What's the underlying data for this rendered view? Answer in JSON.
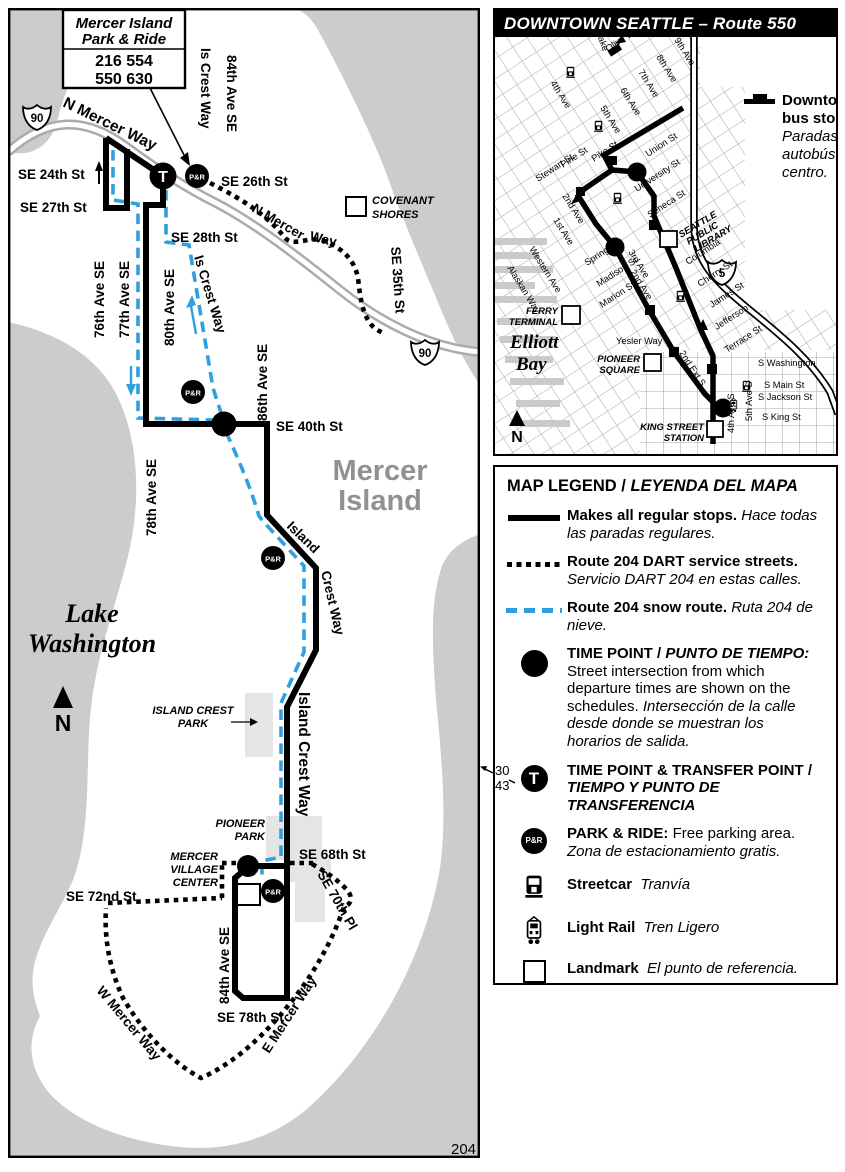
{
  "theme": {
    "snow_route_blue": "#2FA0DB",
    "water_gray": "#CBCDCC",
    "park_gray": "#E4E5E5",
    "route_black": "#000000"
  },
  "main_map": {
    "t": "T",
    "pr": "P&R",
    "shield": "90",
    "page": "204",
    "box": {
      "line1": "Mercer Island",
      "line2": "Park & Ride",
      "row1": "216  554",
      "row2": "550  630"
    },
    "streets": {
      "nmw": "N Mercer Way",
      "se24": "SE 24th St",
      "se27": "SE 27th St",
      "a76": "76th Ave SE",
      "a77": "77th Ave SE",
      "iscn": "Is Crest Way",
      "a84n": "84th Ave SE",
      "se26": "SE 26th St",
      "nm2a": "N Mercer",
      "nm2b": "Way",
      "se28": "SE 28th St",
      "se35": "SE 35th St",
      "a80": "80th Ave SE",
      "iscm": "Is Crest Way",
      "a86": "86th Ave SE",
      "se40": "SE 40th St",
      "a78": "78th Ave SE",
      "icw1a": "Island",
      "icw1b": "Crest Way",
      "icw2": "Island Crest Way",
      "se68": "SE 68th St",
      "se72": "SE 72nd St",
      "se70": "SE 70th Pl",
      "a84s": "84th Ave SE",
      "se78": "SE 78th St",
      "wm": "W Mercer Way",
      "em": "E Mercer Way"
    },
    "places": {
      "m1": "Mercer",
      "m2": "Island",
      "l1": "Lake",
      "l2": "Washington",
      "cov1": "COVENANT",
      "cov2": "SHORES",
      "icp1": "ISLAND CREST",
      "icp2": "PARK",
      "pp1": "PIONEER",
      "pp2": "PARK",
      "mv1": "MERCER",
      "mv2": "VILLAGE",
      "mv3": "CENTER",
      "north": "N"
    }
  },
  "inset": {
    "title": "DOWNTOWN SEATTLE – Route 550",
    "shield": "5",
    "stops_legend": {
      "l1": "Downtown",
      "l2": "bus stops.",
      "l3": "Paradas de",
      "l4": "autobús del",
      "l5": "centro."
    },
    "streets": {
      "a4": "4th Ave",
      "a5": "5th Ave",
      "a6": "6th Ave",
      "a7": "7th Ave",
      "a8": "8th Ave",
      "a9": "9th Ave",
      "olive": "Olive Way",
      "westlake": "Westlake",
      "stewart": "Stewart St",
      "pine": "Pine St",
      "pike": "Pike St",
      "union": "Union St",
      "university": "University St",
      "seneca": "Seneca St",
      "spring": "Spring St",
      "madison": "Madison St",
      "marion": "Marion St",
      "columbia": "Columbia",
      "cherry": "Cherry St",
      "james": "James St",
      "jefferson": "Jefferson",
      "terrace": "Terrace St",
      "a1": "1st Ave",
      "a2": "2nd Ave",
      "a3": "3rd Ave",
      "western": "Western Ave",
      "alaskan": "Alaskan Way",
      "yesler": "Yesler Way",
      "ext2": "2nd Ext S",
      "a4s": "4th Ave S",
      "a5s": "5th Ave S",
      "swash": "S Washington",
      "smain": "S Main St",
      "sjack": "S Jackson St",
      "sking": "S King St"
    },
    "places": {
      "f1": "FERRY",
      "f2": "TERMINAL",
      "eb1": "Elliott",
      "eb2": "Bay",
      "ps1": "PIONEER",
      "ps2": "SQUARE",
      "ks1": "KING STREET",
      "ks2": "STATION",
      "lib1": "SEATTLE",
      "lib2": "PUBLIC",
      "lib3": "LIBRARY",
      "north": "N"
    }
  },
  "legend": {
    "title1": "MAP LEGEND / ",
    "title2": "LEYENDA DEL MAPA",
    "r1en": "Makes all regular stops. ",
    "r1es": "Hace todas las paradas regulares.",
    "r2en": "Route 204 DART service streets. ",
    "r2es": "Servicio DART 204 en estas calles.",
    "r3en": "Route 204 snow route. ",
    "r3es": "Ruta 204 de nieve.",
    "r4en": "TIME POINT / ",
    "r4es": "PUNTO DE TIEMPO: ",
    "r4desc_en": "Street intersection from which departure times are shown on the schedules. ",
    "r4desc_es": "Intersección de la calle desde donde se muestran los horarios de salida.",
    "n30": "30",
    "n43": "43",
    "t": "T",
    "r5en": "TIME POINT & TRANSFER POINT / ",
    "r5es": "TIEMPO Y PUNTO DE TRANSFERENCIA",
    "pr": "P&R",
    "r6en": "PARK & RIDE: ",
    "r6mid": "Free parking area. ",
    "r6es": "Zona de estacionamiento gratis.",
    "r7en": "Streetcar",
    "r7es": "Tranvía",
    "r8en": "Light Rail",
    "r8es": "Tren Ligero",
    "r9en": "Landmark",
    "r9es": "El punto de referencia."
  }
}
